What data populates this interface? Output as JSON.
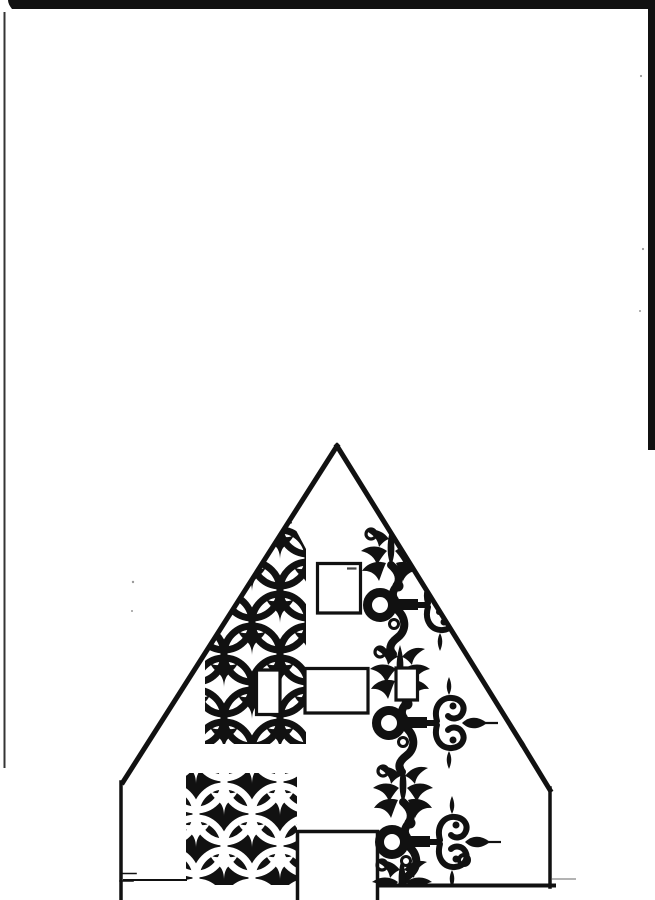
{
  "document": {
    "title": "Scanned ornament drawing - decorated house gable template",
    "description": "Black ink line drawing of a steep triangular house gable decorated with Gothic interlocking-circle tracery, an inverted tracery block, four small rectangular windows, a central doorway, and a vertical scroll ornament of palmettes, rings and heart-shaped scroll finials along the right slope."
  },
  "palette": {
    "ink": "#111111",
    "paper": "#ffffff",
    "gray": "#9a9a9a"
  },
  "scan_artifacts": {
    "top_bar": "M8,0 H655 V9 H12 Q8,4 8,0 Z",
    "right_strip": "M648,0 H655 V450 H648 Z",
    "left_edge": "M4.5,12 V768",
    "floor_ghost": "M552,879 H576",
    "specks": [
      {
        "cx": 133,
        "cy": 582,
        "r": 1.2
      },
      {
        "cx": 132,
        "cy": 611,
        "r": 1.0
      },
      {
        "cx": 641,
        "cy": 76,
        "r": 1.1
      },
      {
        "cx": 643,
        "cy": 249,
        "r": 1.1
      },
      {
        "cx": 640,
        "cy": 311,
        "r": 1.0
      }
    ]
  },
  "house": {
    "roof_left": "M337,446 L123,782",
    "roof_right": "M337,446 L522,744",
    "eave_bevel": "M522,744 L550,790",
    "wall_left": "M121,782 V900",
    "wall_right": "M550,788 V887",
    "floor_right": "M377,885.5 H554",
    "floor_left": "M124,880 H186",
    "floor_ticks": "M122,873.5 H136 M120,881 H133",
    "door": "M297.5,900 V831.5 H377.5 V900",
    "windows": {
      "attic": "M317.5,563.5 H360.5 V613 H317.5 Z",
      "attic_mark": "M347,568.5 H356.5",
      "mid_small": "M256.5,670 H280 V714.5 H256.5 Z",
      "mid_wide": "M305,668.5 H368 V713 H305 Z",
      "scroll_small": "M396,668 H417.5 V700 H396 Z"
    }
  },
  "tracery": {
    "tile": {
      "w": 56,
      "h": 64,
      "r": 28,
      "circles": [
        {
          "cx": 28,
          "cy": 14
        },
        {
          "cx": 28,
          "cy": 78
        },
        {
          "cx": -28,
          "cy": 14
        },
        {
          "cx": 84,
          "cy": 14
        },
        {
          "cx": 0,
          "cy": 46
        },
        {
          "cx": 56,
          "cy": 46
        },
        {
          "cx": 0,
          "cy": -18
        },
        {
          "cx": 56,
          "cy": -18
        }
      ],
      "trefoil": "M0,0 C4,4 9,4 14,1 C11,8 6,10 3,14 C1,17 0,21 0,26 C0,21 -1,17 -3,14 C-6,10 -11,8 -14,1 C-9,4 -4,4 0,0 Z",
      "trefoil_positions": [
        "translate(28,-10)",
        "translate(28,54)",
        "translate(0,22)",
        "translate(56,22)"
      ]
    },
    "band_points": "290,519 306,549 306,744 205,744 205,657 217,635",
    "block": "M186,773 H297 V885 H186 Z"
  },
  "scrollwork": {
    "clip_points": "337,447 521,743 549,789 549,884 299,884 299,527",
    "fleur": {
      "bud": "M0,-26 C3,-16 4,-8 3,2 C2,8 1,10 0,14 C-1,10 -2,8 -3,2 C-4,-8 -3,-16 0,-26 Z",
      "leaf_upper": "M-2,-14 C-8,-22 -16,-25 -25,-22 C-17,-18 -13,-13 -12,-6 C-8,-11 -5,-13 -2,-14 Z",
      "leaf_mid": "M-4,-2 C-12,-8 -22,-8 -30,-2 C-21,0 -16,5 -14,12 C-10,5 -7,1 -4,-2 Z",
      "leaf_lower": "M-5,10 C-14,7 -24,10 -29,18 C-21,17 -15,21 -12,28 C-9,20 -7,14 -5,10 Z",
      "bud_ring": {
        "cx": -20,
        "cy": -19,
        "r": 5
      }
    },
    "unit": {
      "stem": "M0,12 C8,19 10,27 5,34 C1,39 1,43 4,47",
      "lower_scroll": "M4,55 C15,63 17,77 6,85 C-2,91 -2,97 2,101",
      "ring": {
        "cx": -11,
        "cy": 52,
        "r": 12.5
      },
      "curl_a": {
        "cx": 7,
        "cy": 33,
        "r": 4
      },
      "curl_b": {
        "cx": 3,
        "cy": 71,
        "r": 4.5
      },
      "arm": "M1,46 H27 V57 H1 Z M27,49 H38 V55 H27 Z",
      "scroll_up": "M37,50 C33,36 41,26 52,27 C62,28 66,36 62,43 C59,48 52,49 48,45",
      "scroll_down": "M37,54 C33,68 41,78 52,77 C62,76 66,68 62,61 C59,56 52,55 48,59",
      "dot_up": {
        "cx": 53,
        "cy": 35,
        "r": 3.5
      },
      "dot_down": {
        "cx": 53,
        "cy": 69,
        "r": 3.5
      },
      "spear": "M62,52 C68,46 77,44 87,52 C77,60 68,58 62,52 Z",
      "spear_shaft": "M85,52 H98",
      "spike_top": "M49,24 C52,18 52,13 49,6 C46,13 46,18 49,24 Z",
      "spike_bottom": "M49,80 C52,86 52,91 49,98 C46,91 46,86 49,80 Z"
    },
    "units": [
      {
        "transform": "translate(391,553)"
      },
      {
        "transform": "translate(400,671)"
      },
      {
        "transform": "translate(403,790)"
      }
    ],
    "base_fleur_transform": "translate(402,884)",
    "base_ring": {
      "cx": 464,
      "cy": 860,
      "r": 5
    }
  }
}
